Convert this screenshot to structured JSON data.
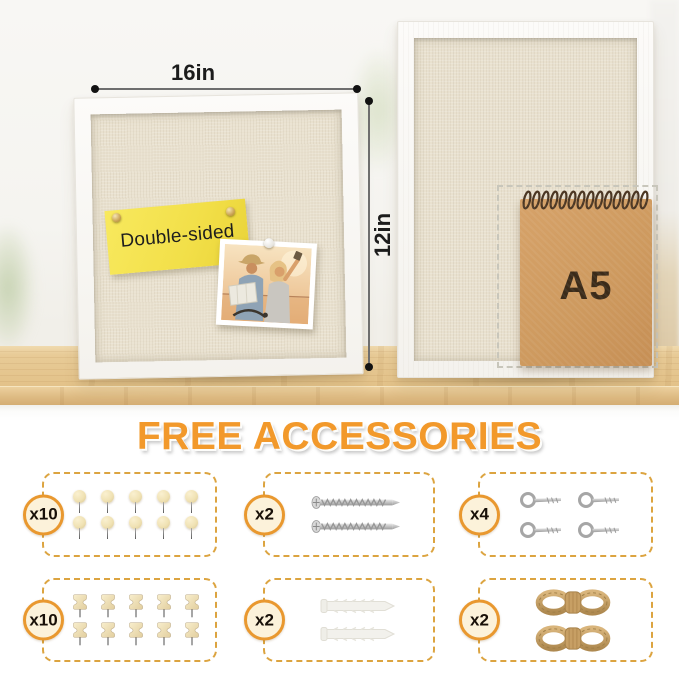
{
  "product_photo": {
    "front_board": {
      "sticky_note_text": "Double-sided",
      "width_label": "16in",
      "height_label": "12in"
    },
    "notebook": {
      "size_label": "A5"
    }
  },
  "accessories_section": {
    "heading": "FREE ACCESSORIES",
    "colors": {
      "heading_orange": "#F2992B",
      "box_dash": "#DCA440",
      "badge_border": "#E9982F",
      "badge_fill": "#FCF2DA"
    },
    "items": [
      {
        "name": "wooden ball push pins",
        "icon": "wooden-ball-pin-icon",
        "count": 10,
        "count_label": "x10"
      },
      {
        "name": "mounting screws",
        "icon": "screw-icon",
        "count": 2,
        "count_label": "x2"
      },
      {
        "name": "eye hook screws",
        "icon": "eye-hook-icon",
        "count": 4,
        "count_label": "x4"
      },
      {
        "name": "wooden push pins",
        "icon": "wooden-push-pin-icon",
        "count": 10,
        "count_label": "x10"
      },
      {
        "name": "wall anchors",
        "icon": "wall-anchor-icon",
        "count": 2,
        "count_label": "x2"
      },
      {
        "name": "jute twine ropes",
        "icon": "jute-twine-icon",
        "count": 2,
        "count_label": "x2"
      }
    ]
  }
}
